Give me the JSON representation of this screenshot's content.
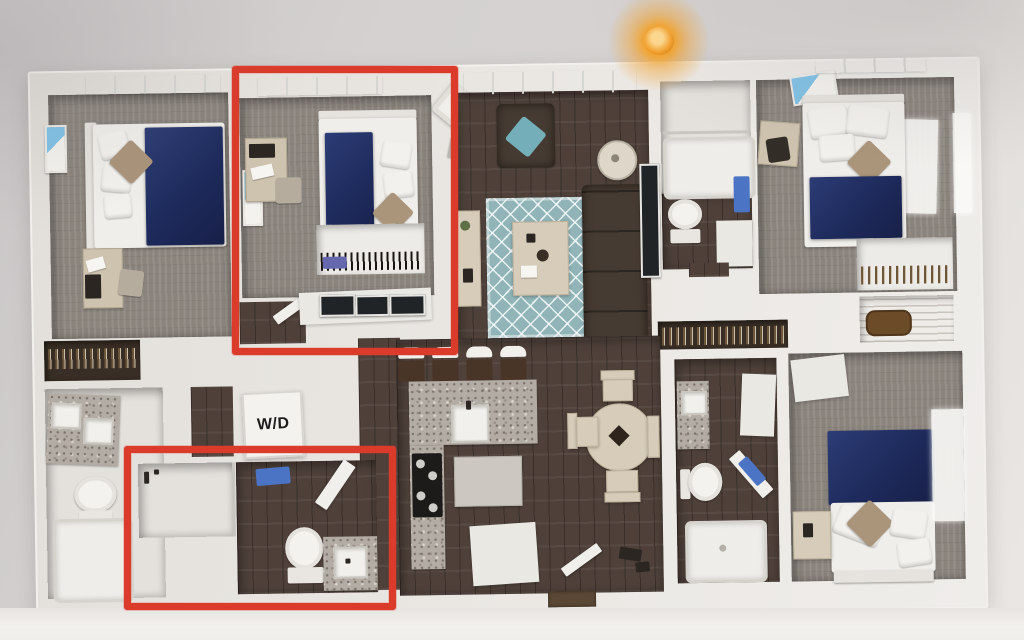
{
  "labels": {
    "washer_dryer": "W/D"
  },
  "colors": {
    "highlight": "#da3b2a",
    "bed_navy": "#1c2a5e",
    "rug_teal": "#8fb4b8",
    "wood_floor": "#50413a",
    "carpet_gray": "#8b847d",
    "wall_white": "#e9e6e2",
    "background_gray": "#d6d3d2",
    "pillow_tan": "#ab9478",
    "pillow_teal": "#72b0ba",
    "towel_blue": "#4a74c8",
    "ceiling_light_orange": "#f5a02a",
    "granite_gray": "#b3aca4",
    "sofa_brown": "#463b31",
    "table_beige": "#d7ccb8"
  },
  "annotations": {
    "border_width": 7,
    "highlight_boxes": [
      {
        "name": "highlighted-bedroom",
        "left": 232,
        "top": 66,
        "width": 212,
        "height": 275
      },
      {
        "name": "highlighted-bathroom",
        "left": 124,
        "top": 446,
        "width": 258,
        "height": 150
      }
    ]
  }
}
